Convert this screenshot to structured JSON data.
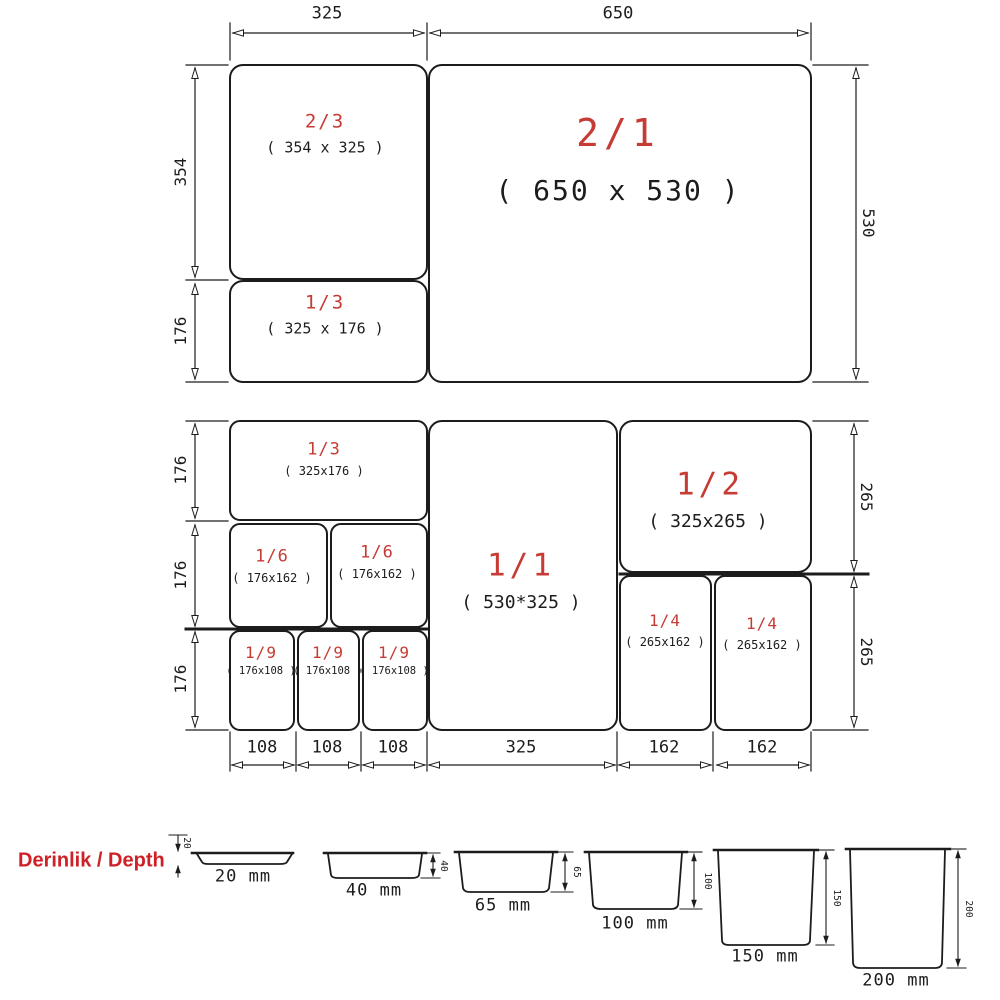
{
  "colors": {
    "ink": "#1c1c1c",
    "accent_red": "#c63b33",
    "title_red": "#ce2127",
    "background": "#ffffff"
  },
  "grid1": {
    "top_dims": [
      "325",
      "650"
    ],
    "left_dims": [
      "354",
      "176"
    ],
    "right_dims": [
      "530"
    ],
    "pans": [
      {
        "name": "2/3",
        "size": "( 354 x 325 )"
      },
      {
        "name": "1/3",
        "size": "( 325 x 176 )"
      },
      {
        "name": "2/1",
        "size": "( 650 x 530 )"
      }
    ]
  },
  "grid2": {
    "left_dims": [
      "176",
      "176",
      "176"
    ],
    "right_dims": [
      "265",
      "265"
    ],
    "bottom_dims": [
      "108",
      "108",
      "108",
      "325",
      "162",
      "162"
    ],
    "pans": [
      {
        "name": "1/3",
        "size": "( 325x176 )"
      },
      {
        "name": "1/6",
        "size": "( 176x162 )"
      },
      {
        "name": "1/6",
        "size": "( 176x162 )"
      },
      {
        "name": "1/9",
        "size": "( 176x108 )"
      },
      {
        "name": "1/9",
        "size": "( 176x108 )"
      },
      {
        "name": "1/9",
        "size": "( 176x108 )"
      },
      {
        "name": "1/1",
        "size": "( 530*325 )"
      },
      {
        "name": "1/2",
        "size": "( 325x265 )"
      },
      {
        "name": "1/4",
        "size": "( 265x162 )"
      },
      {
        "name": "1/4",
        "size": "( 265x162 )"
      }
    ]
  },
  "depth": {
    "title": "Derinlik / Depth",
    "items": [
      {
        "dim": "20",
        "label": "20 mm"
      },
      {
        "dim": "40",
        "label": "40 mm"
      },
      {
        "dim": "65",
        "label": "65 mm"
      },
      {
        "dim": "100",
        "label": "100 mm"
      },
      {
        "dim": "150",
        "label": "150 mm"
      },
      {
        "dim": "200",
        "label": "200 mm"
      }
    ]
  }
}
